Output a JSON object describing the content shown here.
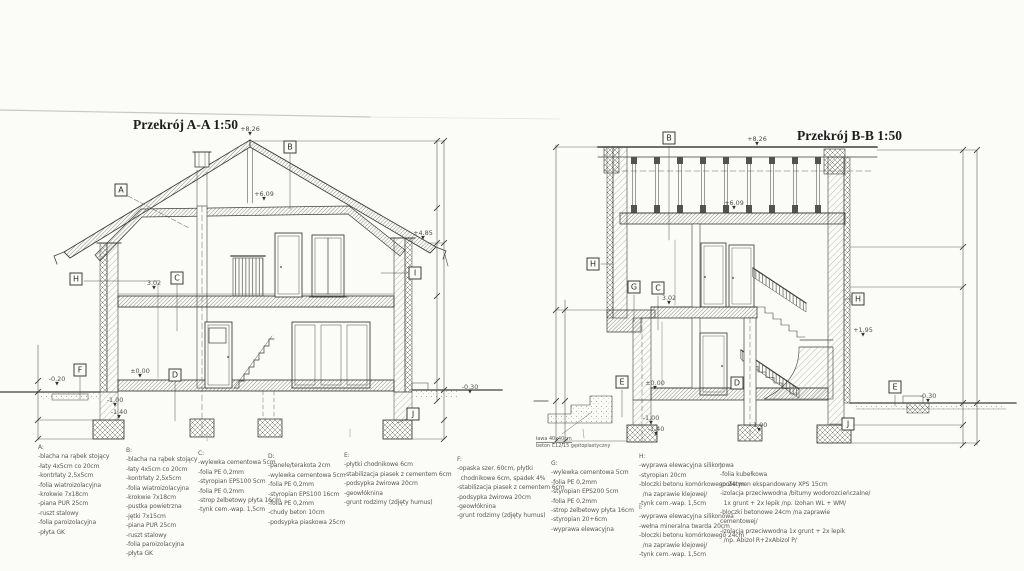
{
  "sections": [
    {
      "id": "section-a",
      "title": "Przekrój A-A 1:50",
      "title_pos": {
        "x": 133,
        "y": 117
      },
      "labels": [
        {
          "t": "A",
          "x": 121,
          "y": 190
        },
        {
          "t": "B",
          "x": 290,
          "y": 147
        },
        {
          "t": "C",
          "x": 177,
          "y": 278
        },
        {
          "t": "D",
          "x": 175,
          "y": 375
        },
        {
          "t": "F",
          "x": 80,
          "y": 370
        },
        {
          "t": "H",
          "x": 76,
          "y": 279
        },
        {
          "t": "I",
          "x": 415,
          "y": 273
        },
        {
          "t": "J",
          "x": 413,
          "y": 414
        }
      ],
      "elevations": [
        {
          "t": "+8.26",
          "x": 250,
          "y": 126
        },
        {
          "t": "+6.09",
          "x": 264,
          "y": 191
        },
        {
          "t": "+4.85",
          "x": 423,
          "y": 230
        },
        {
          "t": "3.02",
          "x": 154,
          "y": 280
        },
        {
          "t": "±0.00",
          "x": 140,
          "y": 368
        },
        {
          "t": "-1.00",
          "x": 115,
          "y": 397
        },
        {
          "t": "-1.40",
          "x": 119,
          "y": 409
        },
        {
          "t": "-0.20",
          "x": 57,
          "y": 376
        },
        {
          "t": "-0.30",
          "x": 470,
          "y": 384
        }
      ]
    },
    {
      "id": "section-b",
      "title": "Przekrój B-B 1:50",
      "title_pos": {
        "x": 797,
        "y": 128
      },
      "labels": [
        {
          "t": "B",
          "x": 669,
          "y": 138
        },
        {
          "t": "H",
          "x": 593,
          "y": 264
        },
        {
          "t": "G",
          "x": 634,
          "y": 287
        },
        {
          "t": "C",
          "x": 658,
          "y": 288
        },
        {
          "t": "E",
          "x": 622,
          "y": 382
        },
        {
          "t": "D",
          "x": 737,
          "y": 383
        },
        {
          "t": "H",
          "x": 858,
          "y": 299
        },
        {
          "t": "E",
          "x": 895,
          "y": 387
        },
        {
          "t": "J",
          "x": 848,
          "y": 424
        }
      ],
      "elevations": [
        {
          "t": "+8.26",
          "x": 757,
          "y": 136
        },
        {
          "t": "+6.09",
          "x": 734,
          "y": 200
        },
        {
          "t": "3.02",
          "x": 669,
          "y": 295
        },
        {
          "t": "±0.00",
          "x": 655,
          "y": 380
        },
        {
          "t": "-1.00",
          "x": 651,
          "y": 415
        },
        {
          "t": "-1.40",
          "x": 656,
          "y": 426
        },
        {
          "t": "-1.00",
          "x": 759,
          "y": 422
        },
        {
          "t": "+1.95",
          "x": 863,
          "y": 327
        },
        {
          "t": "-0.30",
          "x": 928,
          "y": 393
        }
      ]
    }
  ],
  "footing_note": {
    "x": 536,
    "y": 436,
    "lines": [
      "ława 40x40cm",
      "beton C12/15 gęstoplastyczny"
    ]
  },
  "legend": {
    "columns": [
      {
        "key": "A:",
        "x": 38,
        "y": 443,
        "items": [
          "-blacha na rąbek stojący",
          "-łaty 4x5cm co 20cm",
          "-kontrłaty 2,5x5cm",
          "-folia wiatroizolacyjna",
          "-krokwie 7x18cm",
          "-piana PUR 25cm",
          "-ruszt stalowy",
          "-folia paroizolacyjna",
          "-płyta GK"
        ]
      },
      {
        "key": "B:",
        "x": 126,
        "y": 446,
        "items": [
          "-blacha na rąbek stojący",
          "-łaty 4x5cm co 20cm",
          "-kontrłaty 2,5x5cm",
          "-folia wiatroizolacyjna",
          "-krokwie 7x18cm",
          "-pustka powietrzna",
          "-jętki 7x15cm",
          "-piana PUR 25cm",
          "-ruszt stalowy",
          "-folia paroizolacyjna",
          "-płyta GK"
        ]
      },
      {
        "key": "C:",
        "x": 198,
        "y": 449,
        "items": [
          "-wylewka cementowa 5cm",
          "-folia PE 0,2mm",
          "-styropian EPS100 5cm",
          "-folia PE 0,2mm",
          "-strop żelbetowy płyta 16cm",
          "-tynk cem.-wap. 1,5cm"
        ]
      },
      {
        "key": "D:",
        "x": 268,
        "y": 452,
        "items": [
          "-panele/terakota 2cm",
          "-wylewka cementowa 5cm",
          "-folia PE 0,2mm",
          "-styropian EPS100 16cm",
          "-folia PE 0,2mm",
          "-chudy beton 10cm",
          "-podsypka piaskowa 25cm"
        ]
      },
      {
        "key": "E:",
        "x": 344,
        "y": 451,
        "items": [
          "-płytki chodnikowe 6cm",
          "-stabilizacja piasek z cementem 6cm",
          "-podsypka żwirowa 20cm",
          "-geowłóknina",
          "-grunt rodzimy (zdjęty humus)"
        ]
      },
      {
        "key": "F:",
        "x": 457,
        "y": 455,
        "items": [
          "-opaska szer. 60cm, płytki",
          "  chodnikowe 6cm, spadek 4%",
          "-stabilizacja piasek z cementem 6cm",
          "-podsypka żwirowa 20cm",
          "-geowłóknina",
          "-grunt rodzimy (zdjęty humus)"
        ]
      },
      {
        "key": "G:",
        "x": 551,
        "y": 459,
        "items": [
          "-wylewka cementowa 5cm",
          "-folia PE 0,2mm",
          "-styropian EPS200 5cm",
          "-folia PE 0,2mm",
          "-strop żelbetowy płyta 16cm",
          "-styropian 20+6cm",
          "-wyprawa elewacyjna"
        ]
      },
      {
        "key": "H:",
        "x": 639,
        "y": 452,
        "items": [
          "-wyprawa elewacyjna silikonowa",
          "-styropian 20cm",
          "-bloczki betonu komórkowego 24cm",
          "  /na zaprawie klejowej/",
          "-tynk cem.-wap. 1,5cm"
        ]
      },
      {
        "key": "I:",
        "x": 639,
        "y": 503,
        "items": [
          "-wyprawa elewacyjna silikonowa",
          "-wełna mineralna twarda 20cm",
          "-bloczki betonu komórkowego 24cm",
          "  /na zaprawie klejowej/",
          "-tynk cem.-wap. 1,5cm"
        ]
      },
      {
        "key": "J:",
        "x": 720,
        "y": 461,
        "items": [
          "-folia kubełkowa",
          "-polistyren ekspandowany XPS 15cm",
          "-izolacja przeciwwodna /bitumy wodorozcieńczalne/",
          "  1x grunt + 2x lepik /np. Izohan WL + WM/",
          "-bloczki betonowe 24cm /na zaprawie",
          "cementowej/",
          "-izolacja przeciwwodna 1x grunt + 2x lepik",
          "  /np. Abizol R+2xAbizol P/"
        ]
      }
    ]
  },
  "colors": {
    "paper": "#fbfbf8",
    "ink": "#3f3f3b",
    "text_gray": "#5b5852"
  }
}
